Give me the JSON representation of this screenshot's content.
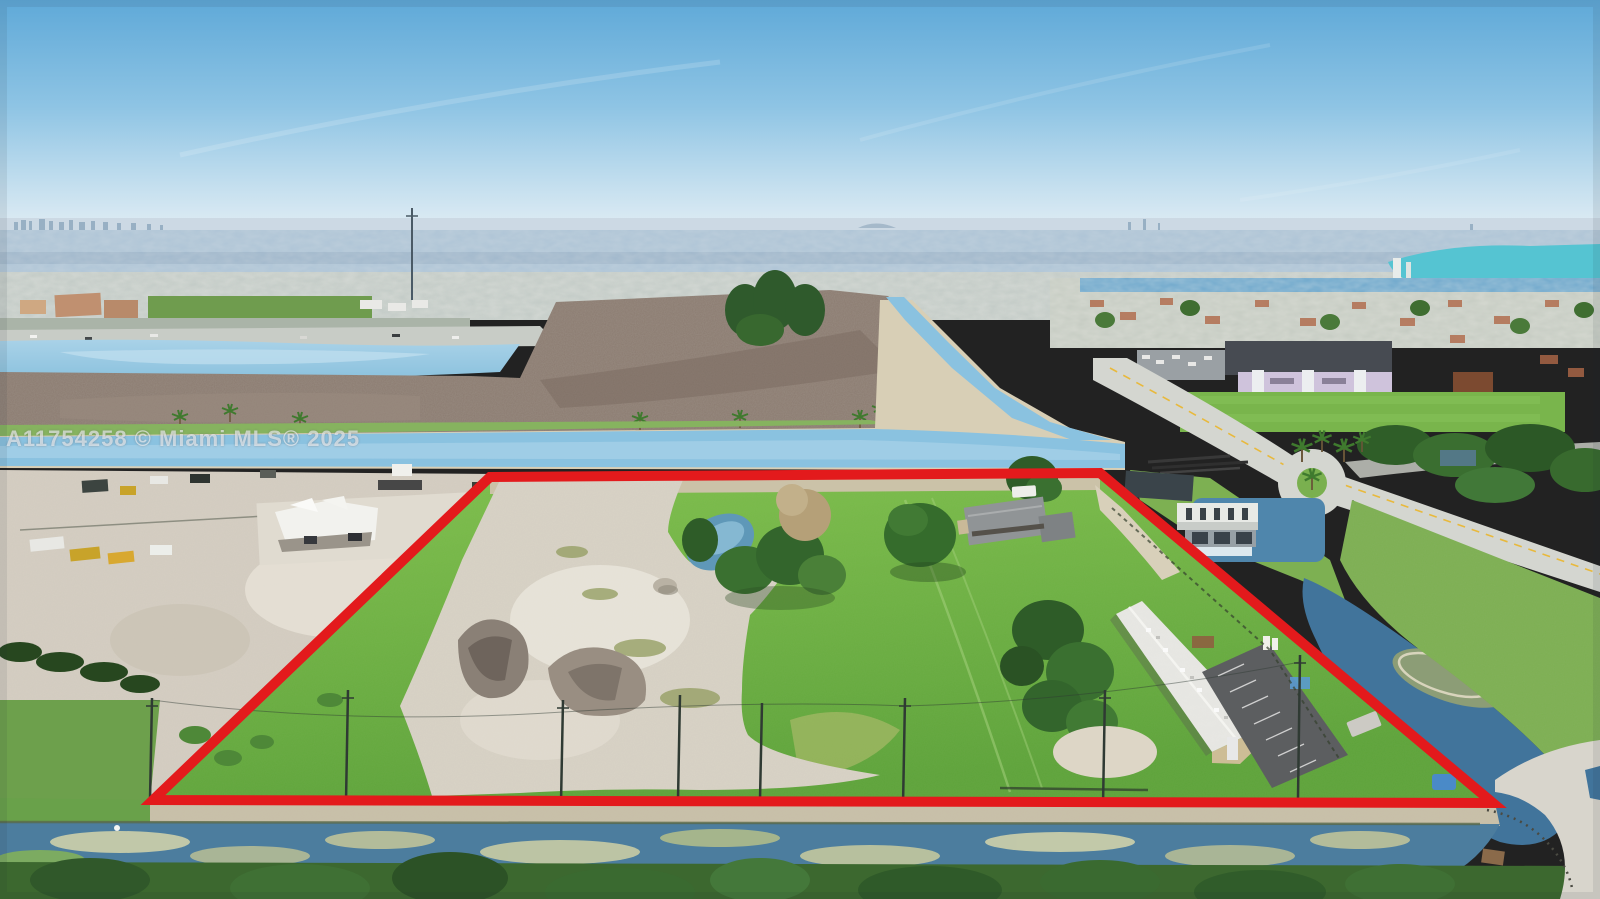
{
  "watermark": {
    "text": "A11754258 © Miami MLS® 2025"
  },
  "scene": {
    "type": "aerial-drone-photo",
    "subject": "vacant-land-parcel-outlined-in-red",
    "colors": {
      "boundary": "#e31a1c",
      "sky_top": "#5fa9d8",
      "sky_horizon": "#e3eef5",
      "canal": "#8ac2e0",
      "grass": "#74b844",
      "dirt": "#d9d3c6",
      "scrub": "#8b7b70",
      "foreground_water": "#4c7d9e"
    }
  }
}
